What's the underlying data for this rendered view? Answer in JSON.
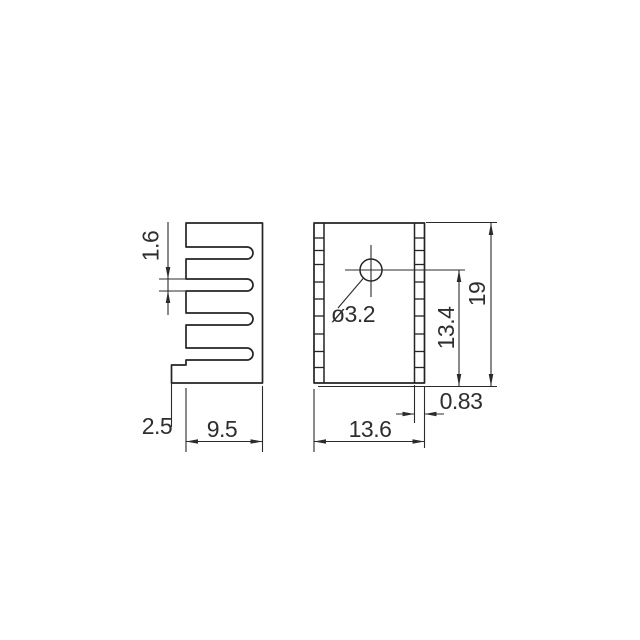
{
  "drawing": {
    "kind": "heatsink-technical-drawing",
    "background_color": "#ffffff",
    "line_color": "#242424",
    "text_color": "#2e2e2e",
    "side_view": {
      "fin_gap": "1.6",
      "tab_width": "2.5",
      "depth": "9.5"
    },
    "front_view": {
      "hole_diameter": "ø3.2",
      "hole_center_to_bottom": "13.4",
      "height": "19",
      "base_thickness": "0.83",
      "width": "13.6"
    }
  }
}
